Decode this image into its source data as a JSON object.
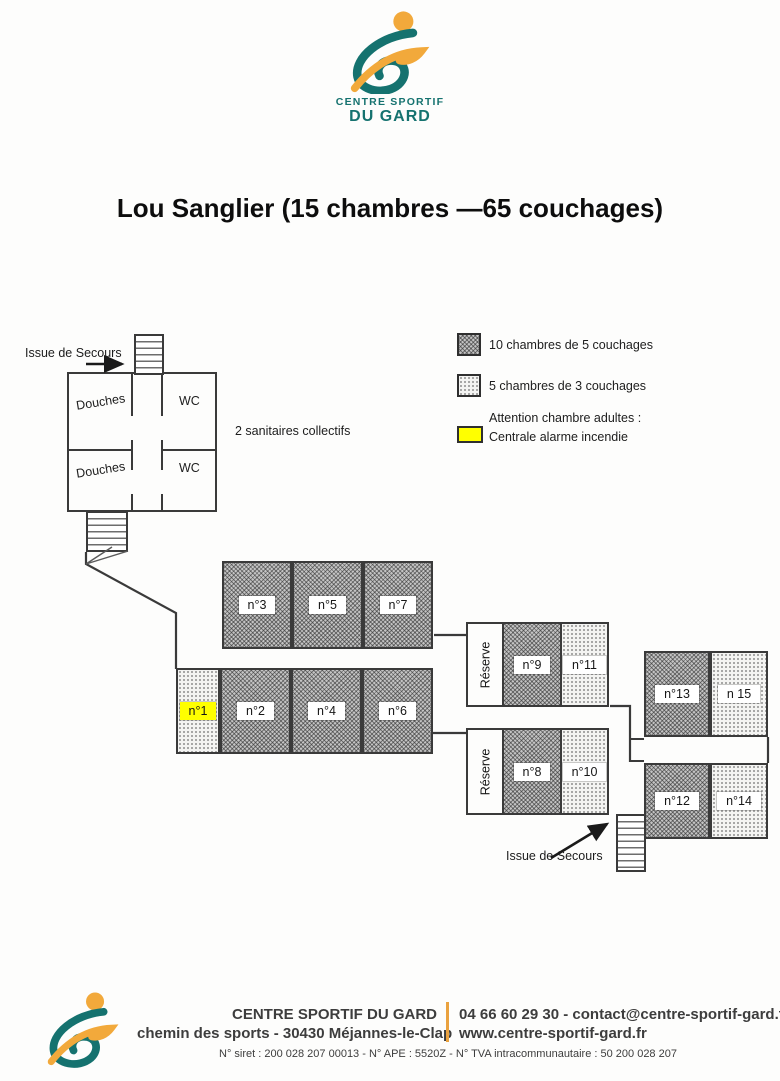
{
  "header_logo": {
    "line1": "CENTRE SPORTIF",
    "line2": "DU GARD"
  },
  "title": "Lou Sanglier (15 chambres —65 couchages)",
  "legend": {
    "dark_label": "10 chambres de 5 couchages",
    "light_label": "5 chambres de 3 couchages",
    "yellow_label_line1": "Attention chambre adultes :",
    "yellow_label_line2": "Centrale alarme incendie"
  },
  "plan": {
    "exit_top": "Issue de Secours",
    "exit_bottom": "Issue de Secours",
    "sanitaires_note": "2 sanitaires collectifs",
    "sanitaires": {
      "douches_top": "Douches",
      "douches_bottom": "Douches",
      "wc_top": "WC",
      "wc_bottom": "WC"
    },
    "reserve_top": "Réserve",
    "reserve_bottom": "Réserve",
    "rooms": {
      "n1": "n°1",
      "n2": "n°2",
      "n3": "n°3",
      "n4": "n°4",
      "n5": "n°5",
      "n6": "n°6",
      "n7": "n°7",
      "n8": "n°8",
      "n9": "n°9",
      "n10": "n°10",
      "n11": "n°11",
      "n12": "n°12",
      "n13": "n°13",
      "n14": "n°14",
      "n15": "n 15"
    }
  },
  "footer": {
    "org_name": "CENTRE SPORTIF DU GARD",
    "address": "chemin des sports - 30430 Méjannes-le-Clap",
    "phone_email": "04 66 60 29 30 - contact@centre-sportif-gard.fr",
    "website": "www.centre-sportif-gard.fr",
    "legal": "N° siret : 200 028 207 00013 - N° APE : 5520Z - N° TVA intracommunautaire : 50 200 028 207"
  },
  "colors": {
    "teal": "#15726f",
    "orange": "#f2a93b",
    "alarm_yellow": "#ffff00",
    "footer_divider": "#eaa23f"
  }
}
